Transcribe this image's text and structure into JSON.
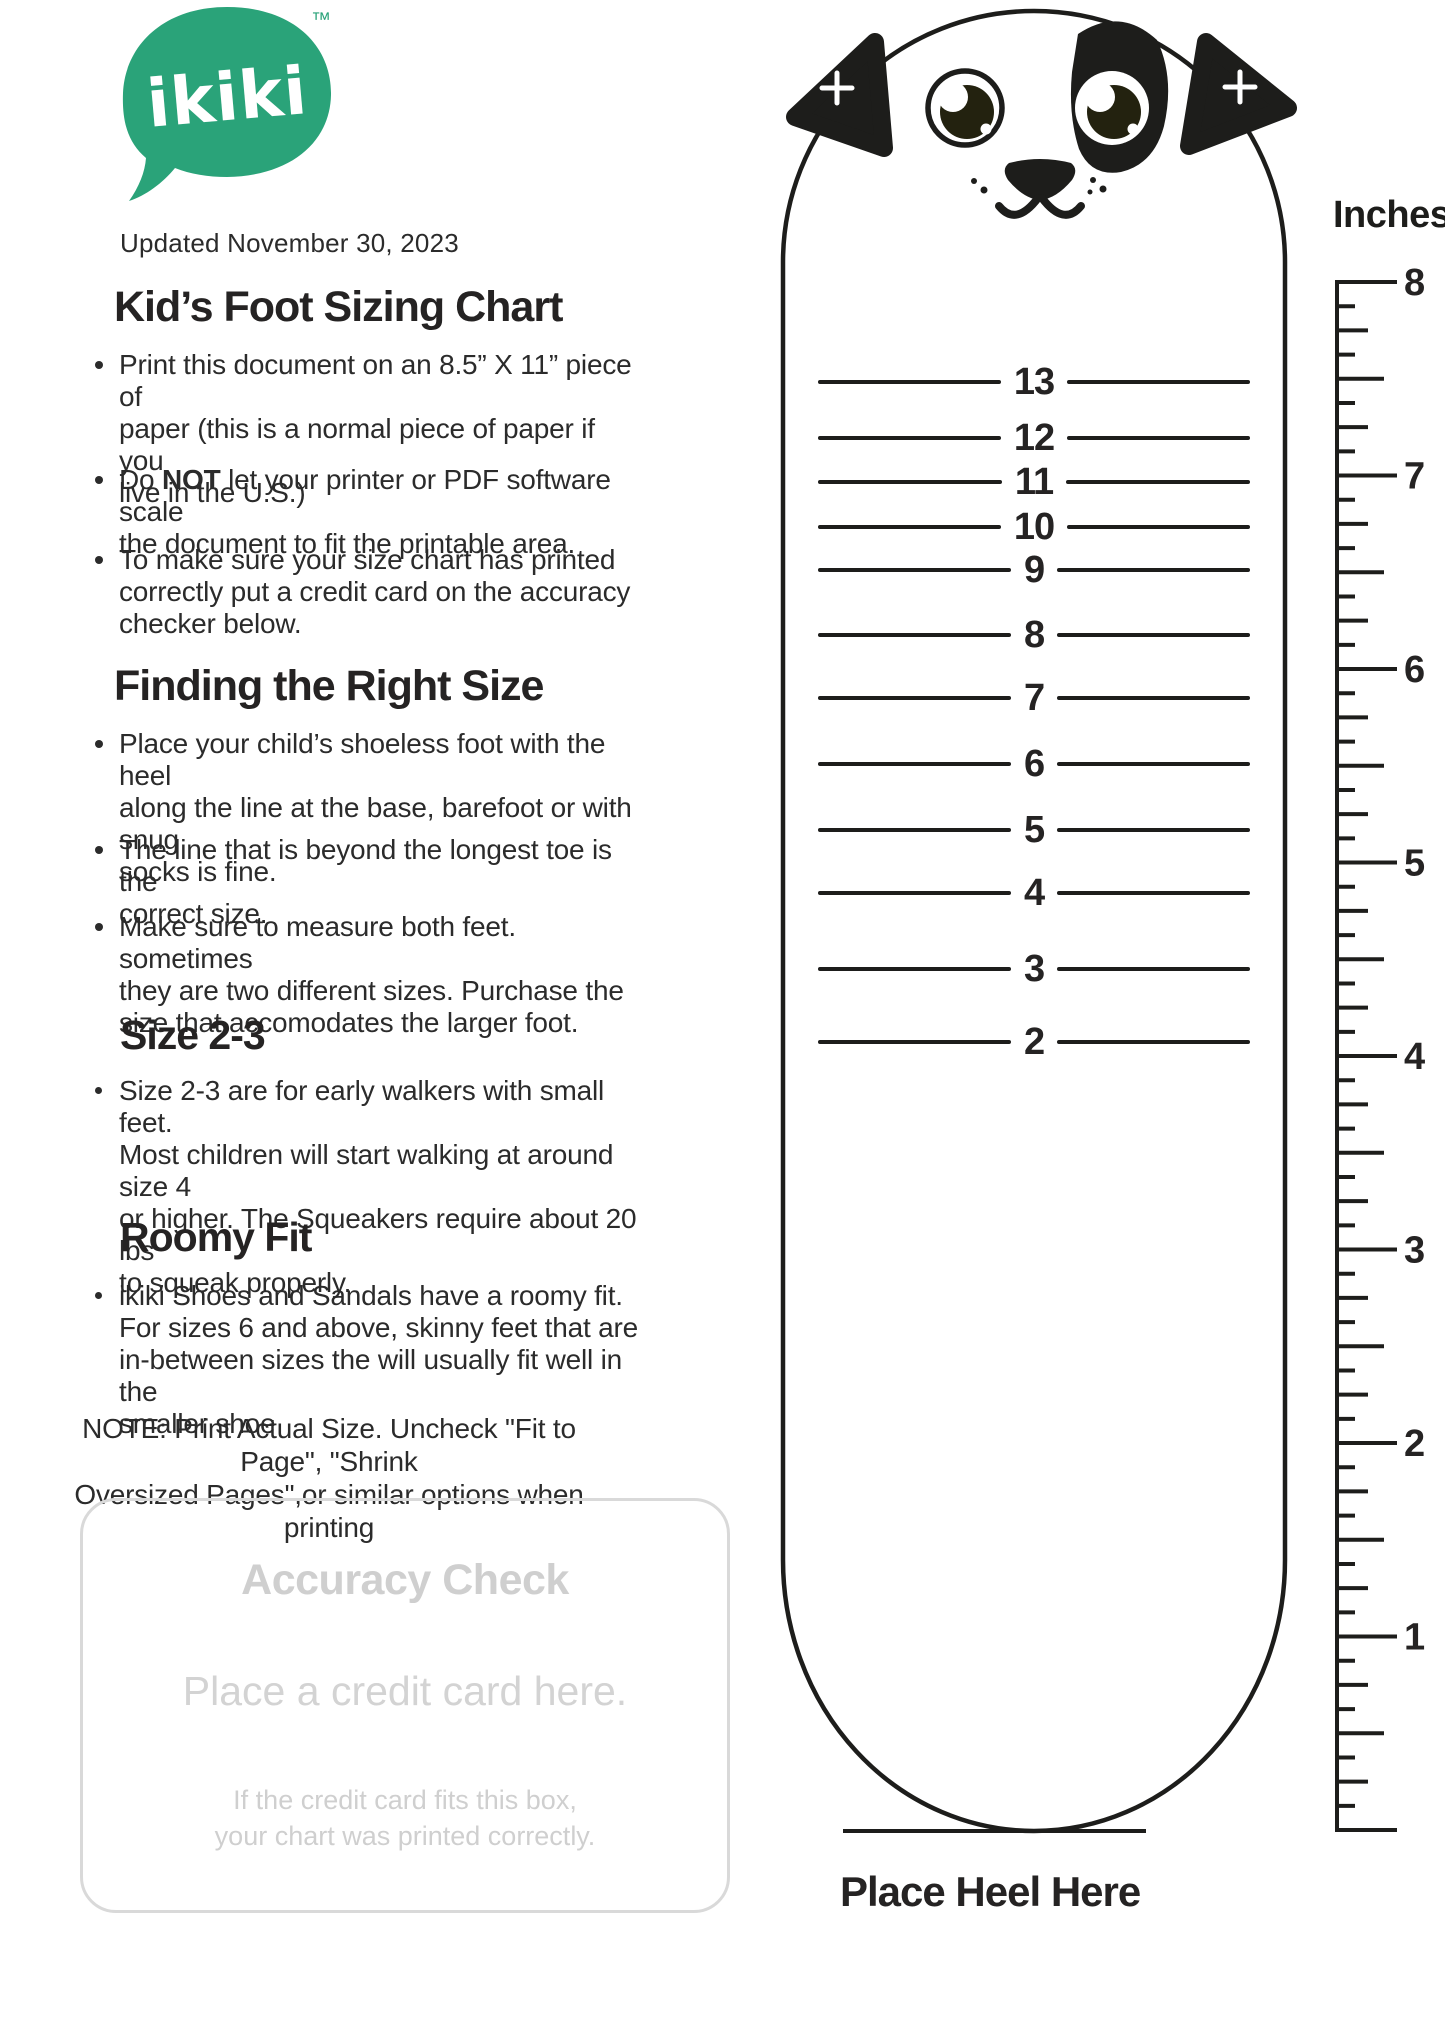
{
  "logo": {
    "brand": "ikiki",
    "tm": "™",
    "color": "#2AA379"
  },
  "updated": "Updated November 30, 2023",
  "sections": [
    {
      "heading": "Kid’s Foot Sizing Chart",
      "bullets": [
        {
          "text": "Print this document on an 8.5” X 11” piece of\npaper (this is a normal piece of paper if you\nlive in the U.S.)"
        },
        {
          "pre": "Do ",
          "bold_word": "NOT",
          "post": " let your printer or PDF software scale\nthe document to fit the printable area."
        },
        {
          "text": "To make sure your size chart has printed\ncorrectly put a credit card on the accuracy\nchecker below."
        }
      ]
    },
    {
      "heading": "Finding the Right Size",
      "bullets": [
        {
          "text": "Place your child’s shoeless foot with the heel\nalong the line at the base, barefoot or with snug\nsocks is fine."
        },
        {
          "text": "The line that is beyond the longest toe is the\ncorrect size."
        },
        {
          "text": "Make sure to measure both feet. sometimes\nthey are two different sizes. Purchase the\nsize that accomodates the larger foot."
        }
      ]
    },
    {
      "heading": "Size 2-3",
      "bullets": [
        {
          "text": "Size 2-3 are for early walkers with small feet.\nMost children will start walking at around size 4\nor higher. The Squeakers require about 20 lbs\nto squeak properly."
        }
      ]
    },
    {
      "heading": "Roomy Fit",
      "bullets": [
        {
          "text": "ikiki Shoes and Sandals have a roomy fit.\nFor sizes 6 and above, skinny feet that are\nin-between sizes the will usually fit well in the\nsmaller shoe"
        }
      ]
    }
  ],
  "note": "NOTE: Print Actual Size. Uncheck \"Fit to Page\", \"Shrink\nOversized Pages\",or similar options when printing",
  "accuracy_check": {
    "title": "Accuracy Check",
    "instruction": "Place a credit card here.",
    "caption": "If the credit card fits this box,\nyour chart was printed correctly."
  },
  "chart_data": {
    "type": "table",
    "title": "Kid's Foot Sizing Chart",
    "heel_label": "Place Heel Here",
    "sizes": [
      {
        "label": "13",
        "y": 382
      },
      {
        "label": "12",
        "y": 438
      },
      {
        "label": "11",
        "y": 482
      },
      {
        "label": "10",
        "y": 527
      },
      {
        "label": "9",
        "y": 570
      },
      {
        "label": "8",
        "y": 635
      },
      {
        "label": "7",
        "y": 698
      },
      {
        "label": "6",
        "y": 764
      },
      {
        "label": "5",
        "y": 830
      },
      {
        "label": "4",
        "y": 893
      },
      {
        "label": "3",
        "y": 969
      },
      {
        "label": "2",
        "y": 1042
      }
    ],
    "ruler": {
      "title": "Inches",
      "labels": [
        "8",
        "7",
        "6",
        "5",
        "4",
        "3",
        "2",
        "1"
      ],
      "top_y": 282,
      "bottom_y": 1830
    },
    "colors": {
      "brand_green": "#2AA379",
      "ink": "#1D1D1B",
      "muted_gray": "#CFCFCF"
    }
  }
}
